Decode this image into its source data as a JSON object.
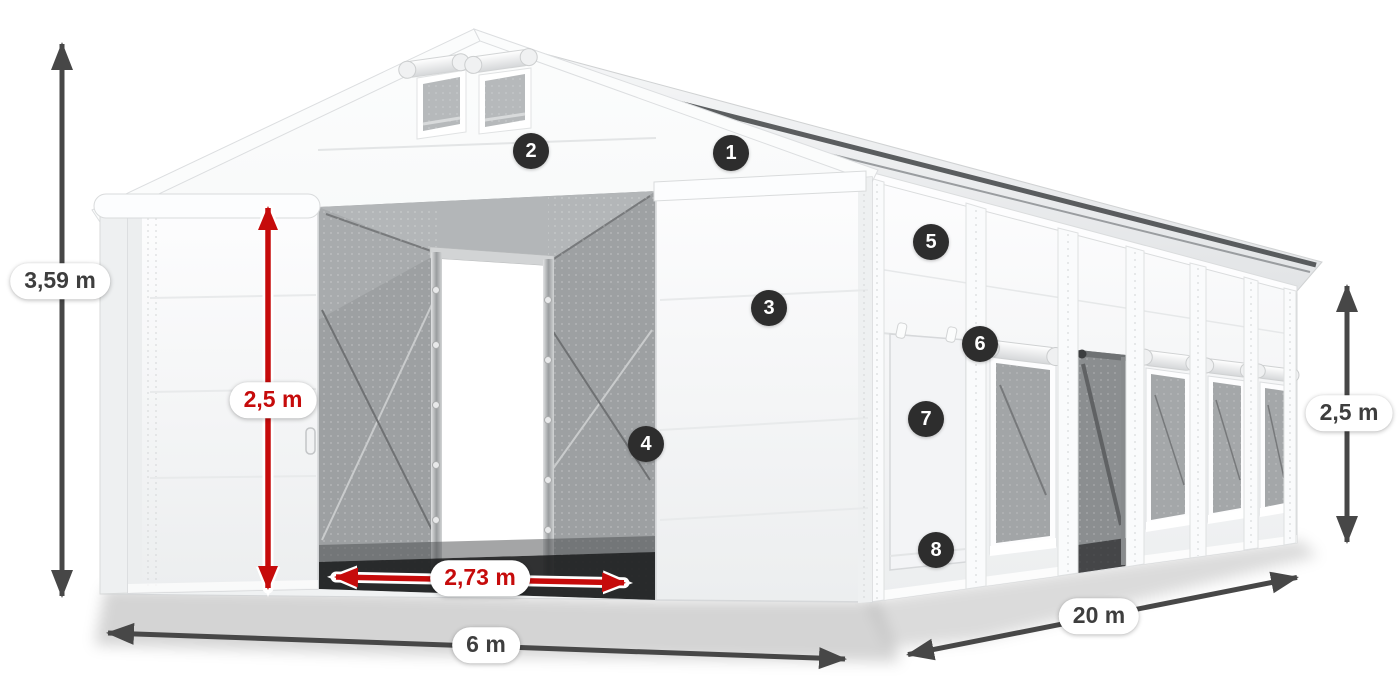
{
  "diagram": {
    "description": "3D product illustration of a white storage tent with dimension arrows and numbered feature markers"
  },
  "dimension_labels": {
    "total_height": "3,59 m",
    "entrance_height": "2,5 m",
    "entrance_width": "2,73 m",
    "front_width": "6 m",
    "side_length": "20 m",
    "side_wall_height": "2,5 m"
  },
  "feature_markers": [
    {
      "number": "1"
    },
    {
      "number": "2"
    },
    {
      "number": "3"
    },
    {
      "number": "4"
    },
    {
      "number": "5"
    },
    {
      "number": "6"
    },
    {
      "number": "7"
    },
    {
      "number": "8"
    }
  ],
  "colors": {
    "background": "#ffffff",
    "dimension_arrow_dark": "#474747",
    "dimension_arrow_red": "#c60b0b",
    "label_pill_background": "#ffffff",
    "label_text_dark": "#3e3e3e",
    "label_text_red": "#c60b0b",
    "marker_background": "#2d2d2d",
    "marker_text": "#ffffff",
    "tent_fabric": "#f5f6f7",
    "mesh_gray": "#9da0a2"
  }
}
